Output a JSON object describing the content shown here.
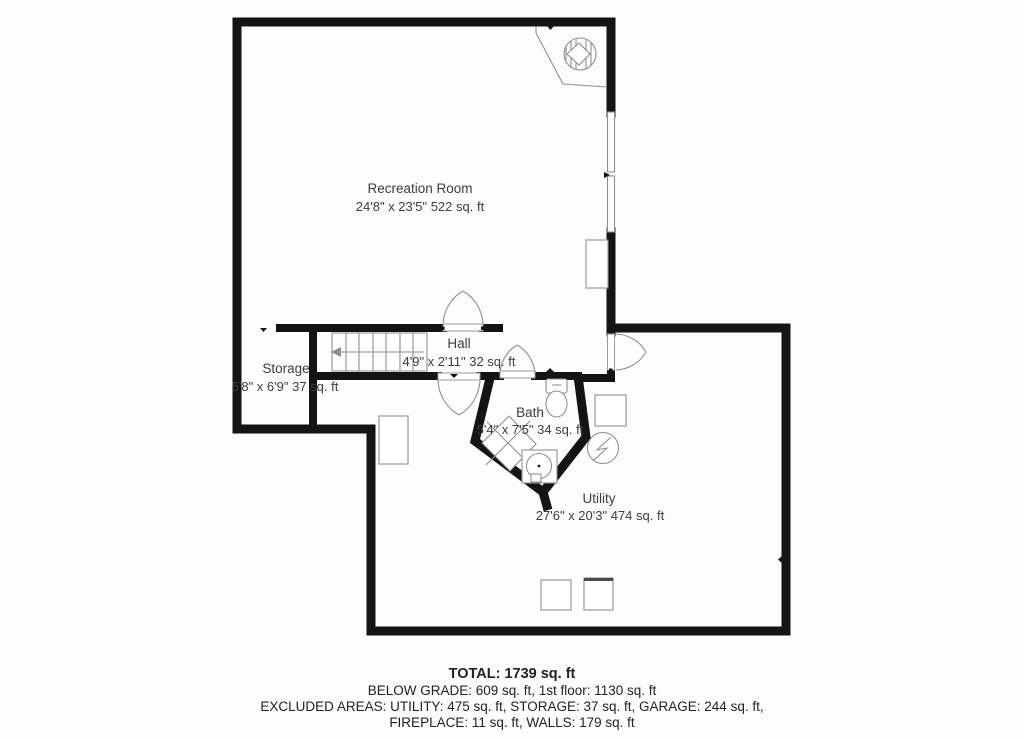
{
  "page": {
    "background": "#fdfdfd",
    "wall_color": "#141414",
    "line_color": "#8f8f8f",
    "text_color": "#3d3d3d"
  },
  "rooms": [
    {
      "id": "recreation",
      "name": "Recreation Room",
      "dimensions": "24'8\" x 23'5\" 522 sq. ft"
    },
    {
      "id": "hall",
      "name": "Hall",
      "dimensions": "4'9\" x 2'11\" 32 sq. ft"
    },
    {
      "id": "storage",
      "name": "Storage",
      "dimensions": "5'8\" x 6'9\" 37 sq. ft"
    },
    {
      "id": "bath",
      "name": "Bath",
      "dimensions": "5'4\" x 7'5\" 34 sq. ft"
    },
    {
      "id": "utility",
      "name": "Utility",
      "dimensions": "27'6\" x 20'3\" 474 sq. ft"
    }
  ],
  "summary": {
    "total": "TOTAL: 1739 sq. ft",
    "below_grade": "BELOW GRADE: 609 sq. ft, 1st floor: 1130 sq. ft",
    "excluded_1": "EXCLUDED AREAS: UTILITY: 475 sq. ft, STORAGE: 37 sq. ft, GARAGE: 244 sq. ft,",
    "excluded_2": "FIREPLACE: 11 sq. ft, WALLS: 179 sq. ft"
  },
  "symbols": [
    "fireplace-icon",
    "staircase-icon",
    "window-icon",
    "door-swing-icon",
    "toilet-icon",
    "shower-icon",
    "sink-icon",
    "water-heater-icon",
    "furnace-icon",
    "appliance-icon",
    "washer-dryer-icon"
  ]
}
